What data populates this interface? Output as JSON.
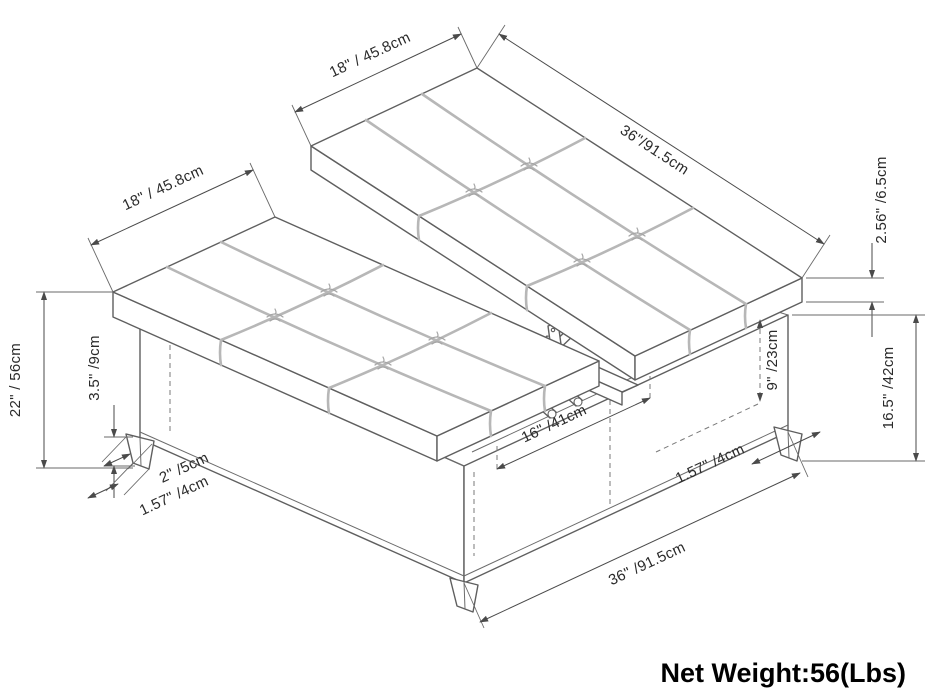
{
  "diagram": {
    "net_weight": "Net Weight:56(Lbs)",
    "dims": {
      "top_left_depth": "18\" / 45.8cm",
      "top_mid_depth": "18\" / 45.8cm",
      "top_right_length": "36\"/91.5cm",
      "lid_thickness": "2.56\" /6.5cm",
      "base_height": "16.5\" /42cm",
      "inner_depth": "9\" /23cm",
      "overall_height": "22\" / 56cm",
      "leg_height": "3.5\" /9cm",
      "leg_top_width": "2\" /5cm",
      "leg_bottom_width": "1.57\" /4cm",
      "opening_width": "16\" /41cm",
      "leg_bottom_width_right": "1.57\" /4cm",
      "bottom_length": "36\" /91.5cm"
    },
    "colors": {
      "outline": "#5f5f5f",
      "seam": "#b7b7b7",
      "dimension": "#4a4a4a",
      "label_text": "#2a2a2a",
      "weight_text": "#000000"
    }
  }
}
